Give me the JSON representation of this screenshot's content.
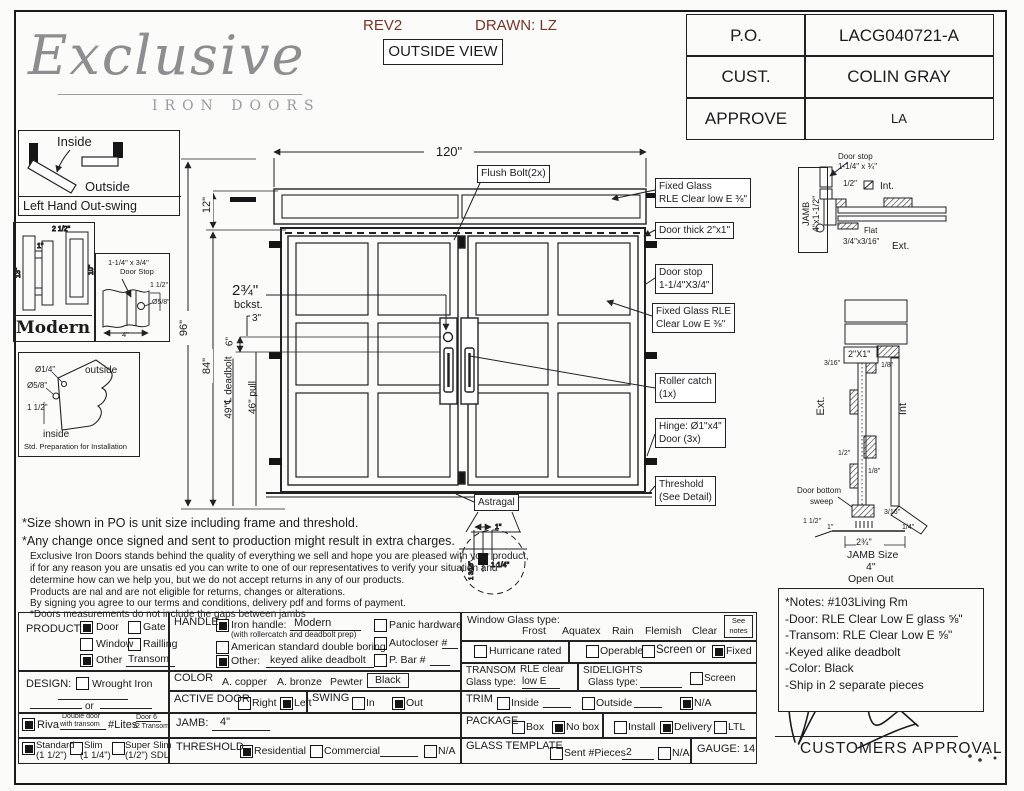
{
  "header": {
    "rev": "REV2",
    "drawn": "DRAWN: LZ",
    "view": "OUTSIDE VIEW"
  },
  "logo": {
    "script": "Exclusive",
    "sub": "IRON DOORS"
  },
  "po_table": {
    "po_label": "P.O.",
    "po_value": "LACG040721-A",
    "cust_label": "CUST.",
    "cust_value": "COLIN GRAY",
    "approve_label": "APPROVE",
    "approve_value": "LA"
  },
  "swing_panel": {
    "inside": "Inside",
    "outside": "Outside",
    "caption": "Left Hand Out-swing"
  },
  "modern_panel": {
    "dim_top": "2 1/2\"",
    "dim_one": "1\"",
    "dim_left": "13\"",
    "dim_right": "10\"",
    "caption": "Modern"
  },
  "doorstop_panel": {
    "line1": "1-1/4\" x 3/4\"",
    "line2": "Door Stop",
    "dim_height": "1 1/2\"",
    "dim_hole": "Ø5/8\"",
    "dim_width": "4\""
  },
  "threshold_panel": {
    "hole_small": "Ø1/4\"",
    "hole_big": "Ø5/8\"",
    "dim": "1 1/2\"",
    "outside": "outside",
    "inside": "inside",
    "caption": "Std. Preparation for Installation"
  },
  "drawing": {
    "dim_width": "120\"",
    "dim_transom": "12\"",
    "dim_total": "96\"",
    "dim_door": "84\"",
    "backset": "2¾\"",
    "backset_label": "bckst.",
    "dim_3": "3\"",
    "dim_6": "6\"",
    "dim_deadbolt": "49\"℄ deadbolt",
    "dim_pull": "46\" pull",
    "callout_flush": "Flush Bolt(2x)",
    "callout_fixed_top_1": "Fixed Glass",
    "callout_fixed_top_2": "RLE Clear low E ⅜\"",
    "callout_thick": "Door thick 2\"x1\"",
    "callout_stop_1": "Door stop",
    "callout_stop_2": "1-1/4\"X3/4\"",
    "callout_fixed_1": "Fixed Glass RLE",
    "callout_fixed_2": "Clear Low E ⅜\"",
    "callout_roller_1": "Roller catch",
    "callout_roller_2": "(1x)",
    "callout_hinge_1": "Hinge: Ø1\"x4\"",
    "callout_hinge_2": "Door (3x)",
    "callout_threshold_1": "Threshold",
    "callout_threshold_2": "(See Detail)",
    "callout_astragal": "Astragal",
    "astragal_d1": "1\"",
    "astragal_d2": "1 1/4\"",
    "astragal_d3": "1 3/16\""
  },
  "jamb_plan": {
    "jamb": "JAMB",
    "jamb_size": "4\"x1-1/2\"",
    "stop1": "Door stop",
    "stop2": "1-1/4\" x ¾\"",
    "half": "1/2\"",
    "int": "Int.",
    "flat": "Flat",
    "flat_dim": "3/4\"x3/16\"",
    "ext": "Ext."
  },
  "jamb_section": {
    "label_2x1": "2\"X1\"",
    "d316": "3/16\"",
    "d18": "1/8\"",
    "ext": "Ext.",
    "int": "Int",
    "d12": "1/2\"",
    "d18b": "1/8\"",
    "sweep1": "Door bottom",
    "sweep2": "sweep",
    "d112": "1 1/2\"",
    "d1": "1\"",
    "d316b": "3/16\"",
    "d14": "1/4\"",
    "d234": "2¾\"",
    "size1": "JAMB Size",
    "size2": "4\"",
    "open": "Open Out"
  },
  "terms": {
    "l1": "*Size shown in PO is unit size including frame and threshold.",
    "l2": "*Any change once signed and sent to production might result in extra charges.",
    "l3": "Exclusive Iron Doors stands behind the quality of everything we sell and hope you are pleased with your product,",
    "l4": "if for any reason you are unsatis ed you can write to one of our representatives to verify your situation and",
    "l5": "determine how can we help you, but we do not accept returns in any of our products.",
    "l6": "Products are  nal and are not eligible for returns, changes or alterations.",
    "l7": "By signing you agree to our terms and conditions, delivery pdf and forms of payment.",
    "l8": "*Doors measurements do not include the gaps between jambs"
  },
  "form": {
    "product": {
      "label": "PRODUCT:",
      "door": "Door",
      "gate": "Gate",
      "window": "Window",
      "railing": "Railling",
      "other": "Other",
      "other_value": "Transom"
    },
    "design": {
      "label": "DESIGN:",
      "wrought": "Wrought Iron",
      "or": "or"
    },
    "riva": {
      "label": "Riva",
      "note1": "Double door",
      "note2": "with transom",
      "lites": "#Lites",
      "lites1": "Door 6",
      "lites2": "/2 Transom"
    },
    "thickness": {
      "standard": "Standard",
      "standard_sub": "(1 1/2\")",
      "slim": "Slim",
      "slim_sub": "(1 1/4\")",
      "super_slim": "Super Slim",
      "super_sub": "(1/2\") SDL"
    },
    "handle": {
      "label": "HANDLE",
      "iron": "Iron handle:",
      "iron_value": "Modern",
      "iron_sub": "(with rollercatch and deadbolt prep)",
      "american": "American standard double boring",
      "other": "Other:",
      "other_value": "keyed alike deadbolt",
      "panic": "Panic hardware",
      "autocloser": "Autocloser #",
      "pbar": "P. Bar #"
    },
    "color": {
      "label": "COLOR",
      "copper": "A. copper",
      "bronze": "A. bronze",
      "pewter": "Pewter",
      "black": "Black"
    },
    "active": {
      "label": "ACTIVE DOOR",
      "right": "Right",
      "left": "Left"
    },
    "swing": {
      "label": "SWING",
      "in": "In",
      "out": "Out"
    },
    "jamb": {
      "label": "JAMB:",
      "value": "4\""
    },
    "threshold": {
      "label": "THRESHOLD",
      "residential": "Residential",
      "commercial": "Commercial",
      "na": "N/A"
    },
    "glass": {
      "label": "Window Glass type:",
      "frost": "Frost",
      "aquatex": "Aquatex",
      "rain": "Rain",
      "flemish": "Flemish",
      "clear": "Clear",
      "see1": "See",
      "see2": "notes",
      "hurricane": "Hurricane rated",
      "operable": "Operable",
      "screen_or": "Screen or",
      "fixed": "Fixed"
    },
    "transom": {
      "label": "TRANSOM",
      "glass_label": "Glass type:",
      "value1": "RLE clear",
      "value2": "low E"
    },
    "sidelights": {
      "label": "SIDELIGHTS",
      "glass_label": "Glass type:",
      "screen": "Screen"
    },
    "trim": {
      "label": "TRIM",
      "inside": "Inside",
      "outside": "Outside",
      "na": "N/A"
    },
    "package": {
      "label": "PACKAGE",
      "box": "Box",
      "nobox": "No box",
      "install": "Install",
      "delivery": "Delivery",
      "ltl": "LTL"
    },
    "template": {
      "label": "GLASS TEMPLATE",
      "sent": "Sent #Pieces",
      "sent_value": "2",
      "na": "N/A",
      "gauge": "GAUGE: 14"
    }
  },
  "notes": {
    "title": "*Notes: #103Living Rm",
    "l1": "-Door: RLE Clear Low E glass ⅝\"",
    "l2": "-Transom: RLE Clear Low E ⅝\"",
    "l3": "-Keyed alike deadbolt",
    "l4": "-Color: Black",
    "l5": "-Ship in 2 separate pieces"
  },
  "approval": {
    "label": "CUSTOMERS APPROVAL"
  }
}
